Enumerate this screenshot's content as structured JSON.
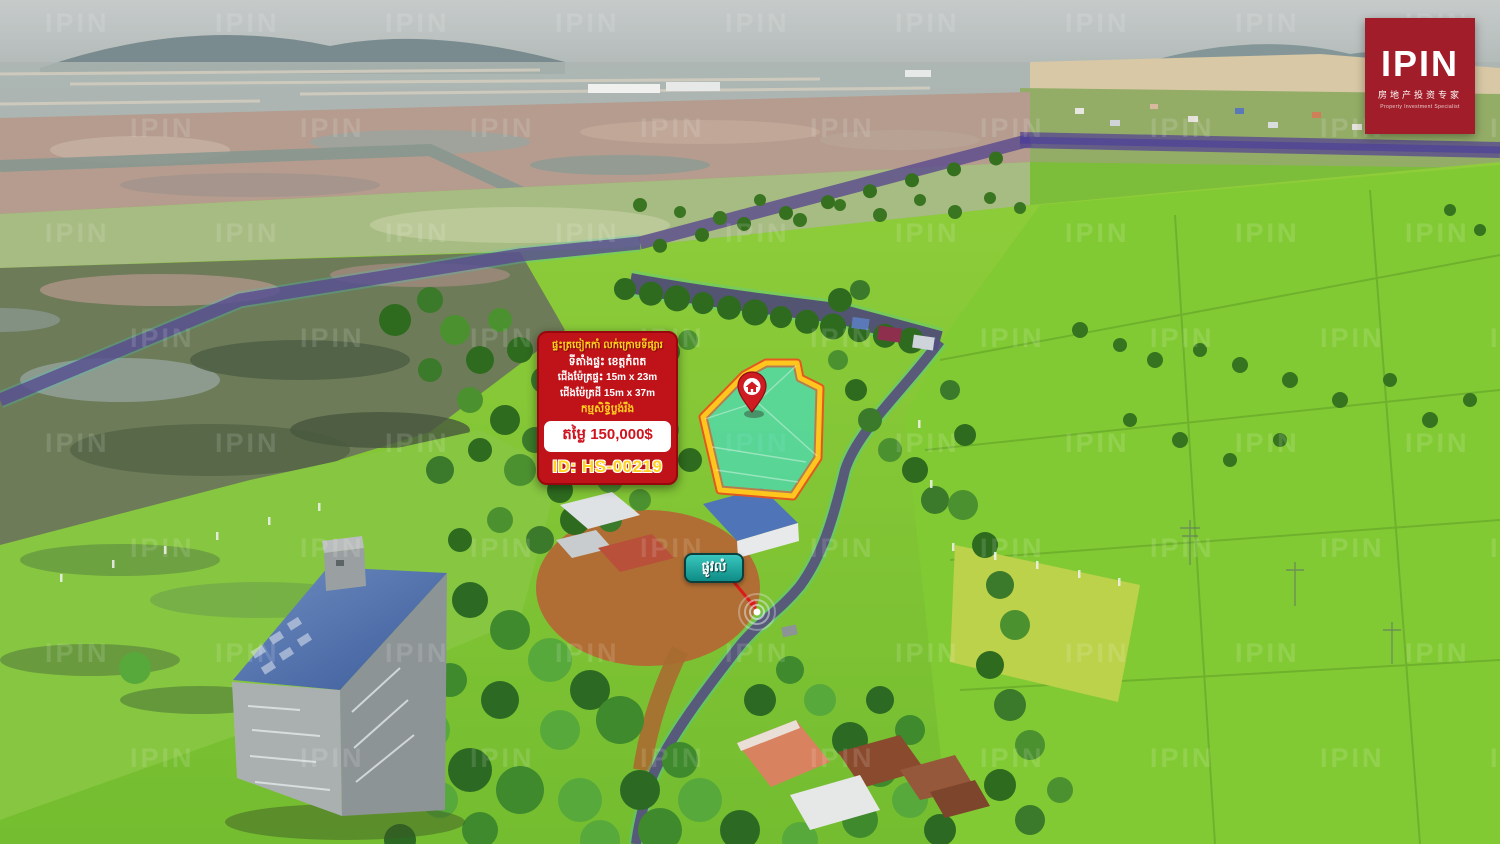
{
  "watermark": {
    "text": "IPIN"
  },
  "logo": {
    "name": "IPIN",
    "chinese": "房地产投资专家",
    "tagline": "Property Investment Specialist",
    "bg_color": "#a11d29"
  },
  "listing_card": {
    "headline": "ផ្ទះត្រចៀកកាំ លក់ក្រោមទីផ្សារ",
    "location": "ទីតាំងផ្ទះ ខេត្តកំពត",
    "house_size": "ជើងម៉ែត្រផ្ទះ 15m x 23m",
    "land_size": "ជើងម៉ែត្រដី 15m x 37m",
    "ownership": "កម្មសិទ្ធិប្លង់រឹង",
    "price": "តម្លៃ 150,000$",
    "listing_id": "ID: HS-00219",
    "bg_color": "#c01319",
    "accent_yellow": "#ffd21f"
  },
  "map_annotations": {
    "road_label": "ផ្លូវលំ",
    "highlight_fill": "#40e0d0",
    "highlight_border": "#ffc61e",
    "route_color": "#5a4a8e",
    "pin_color": "#cf1b22"
  }
}
